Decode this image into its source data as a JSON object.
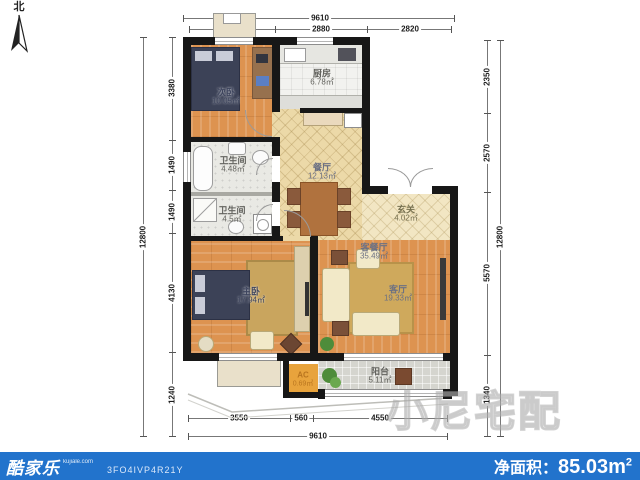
{
  "compass": {
    "north_label": "北"
  },
  "rooms": [
    {
      "name": "次卧",
      "area": "10.05㎡"
    },
    {
      "name": "厨房",
      "area": "6.78㎡"
    },
    {
      "name": "卫生间",
      "area": "4.48㎡"
    },
    {
      "name": "卫生间",
      "area": "4.5㎡"
    },
    {
      "name": "餐厅",
      "area": "12.13㎡"
    },
    {
      "name": "玄关",
      "area": "4.02㎡"
    },
    {
      "name": "客餐厅",
      "area": "35.49㎡"
    },
    {
      "name": "客厅",
      "area": "19.33㎡"
    },
    {
      "name": "主卧",
      "area": "17.94㎡"
    },
    {
      "name": "AC",
      "area": "0.69㎡"
    },
    {
      "name": "阳台",
      "area": "5.11㎡"
    }
  ],
  "dims": {
    "top_total": "9610",
    "top_segments": [
      "2960",
      "2880",
      "2820"
    ],
    "left_total": "12800",
    "left_segments": [
      "3380",
      "1490",
      "1490",
      "4130",
      "1240"
    ],
    "right_total": "12800",
    "right_segments": [
      "2350",
      "2570",
      "5570",
      "1340"
    ],
    "bottom_segments": [
      "3550",
      "560",
      "4550"
    ],
    "bottom_total": "9610"
  },
  "watermark": "小尼宅配",
  "footer": {
    "brand": "酷家乐",
    "brand_site": "kujiale.com",
    "plan_code": "3FO4IVP4R21Y",
    "net_area_label": "净面积：",
    "net_area_value": "85.03",
    "net_area_unit_base": "m",
    "net_area_unit_sup": "2"
  },
  "colors": {
    "footer_bar": "#2273cc",
    "wall": "#171717",
    "wood_floor": "#dd9350",
    "parquet_floor": "#ecd9a8",
    "ac_shaft": "#e8a33c"
  }
}
